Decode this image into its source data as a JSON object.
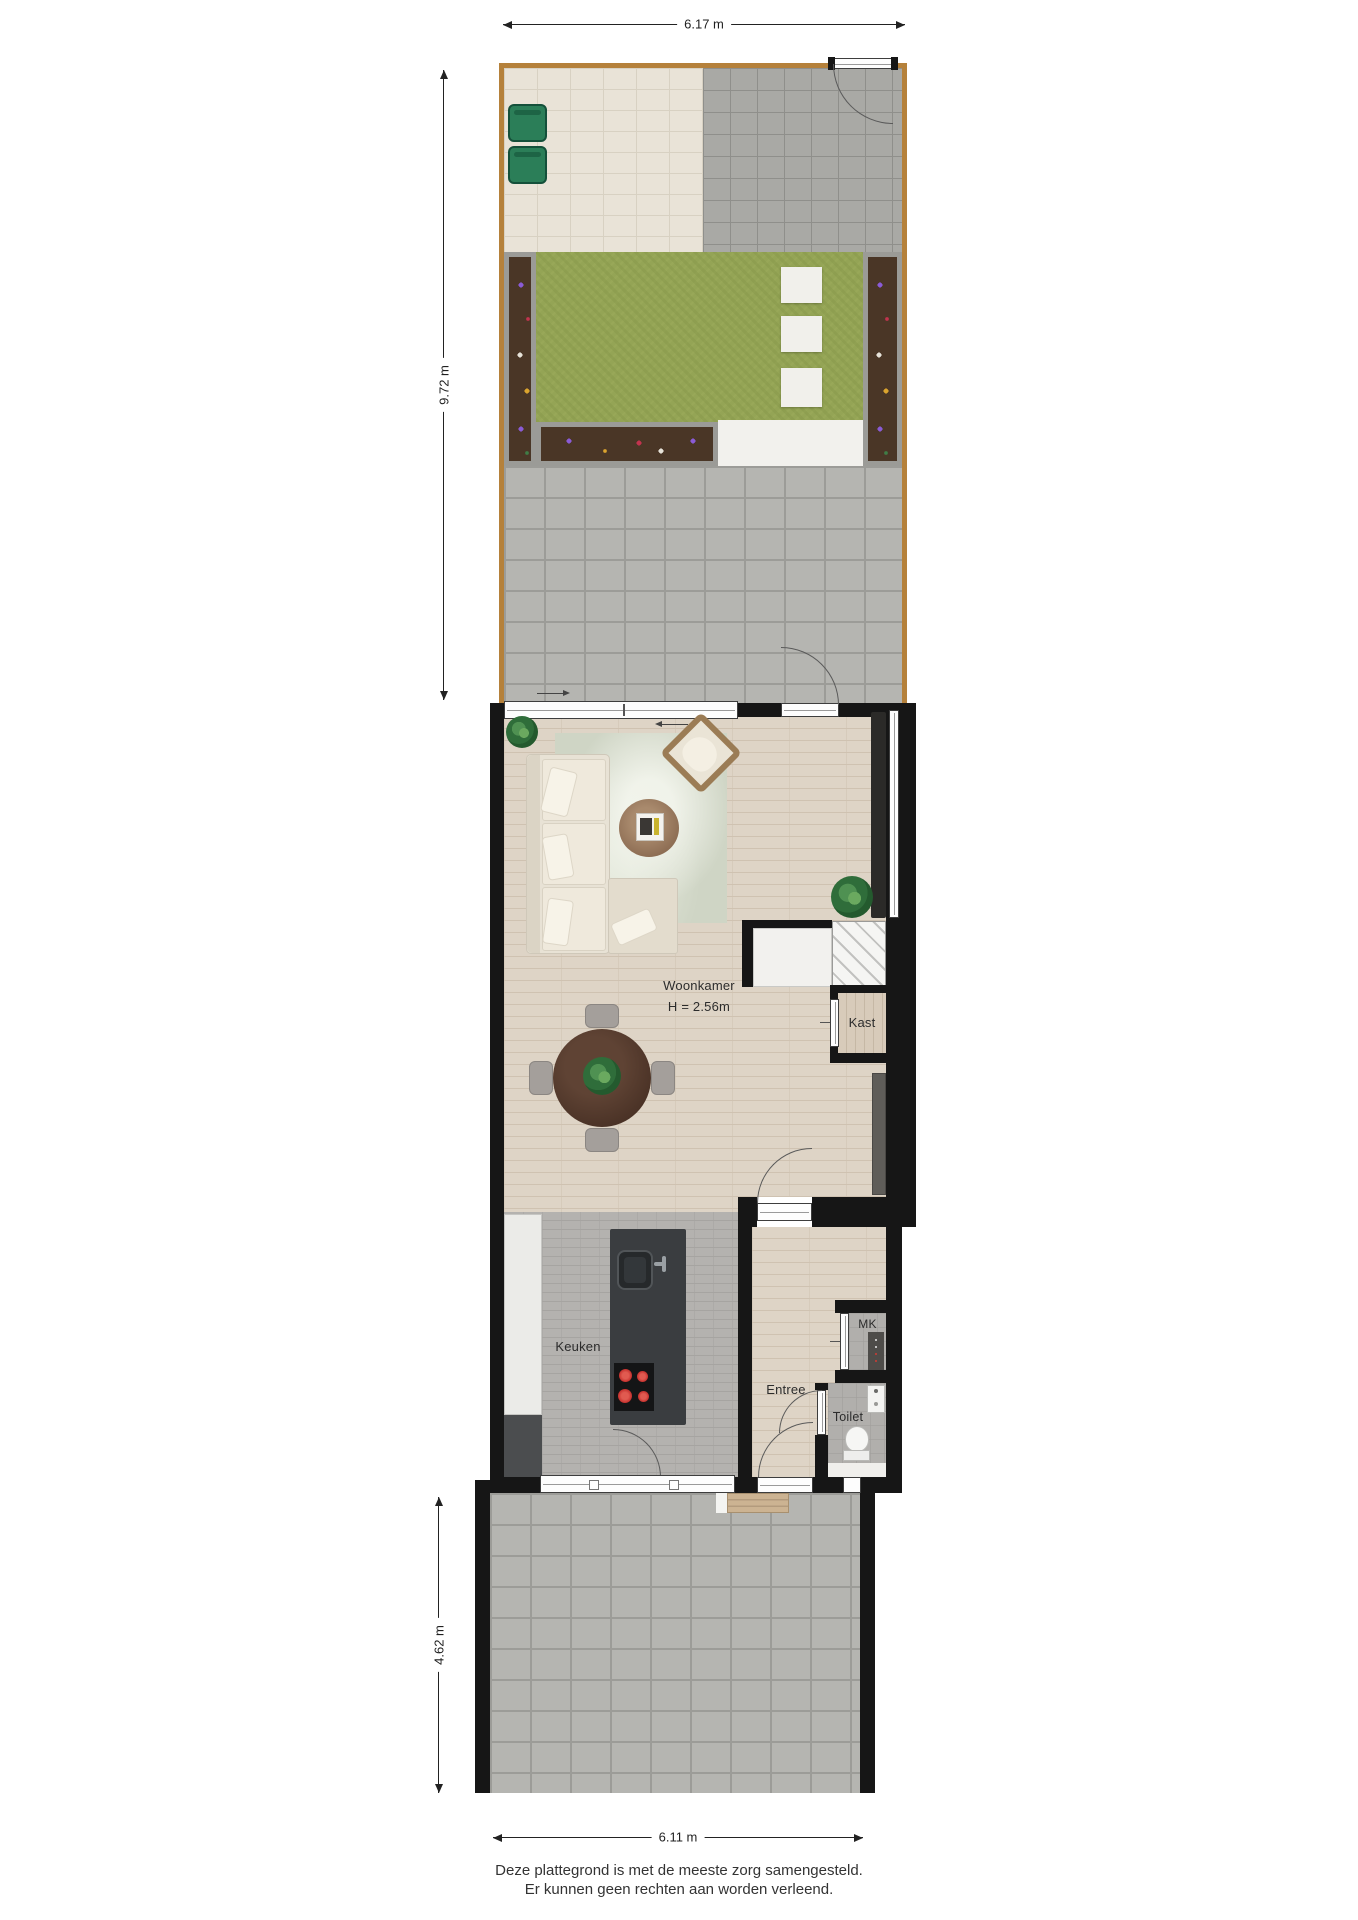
{
  "dimensions": {
    "garden_width": "6.17 m",
    "garden_depth": "9.72 m",
    "front_depth": "4.62 m",
    "front_width": "6.11 m"
  },
  "rooms": {
    "living": {
      "name": "Woonkamer",
      "ceiling": "H = 2.56m"
    },
    "closet": {
      "name": "Kast"
    },
    "kitchen": {
      "name": "Keuken"
    },
    "hall": {
      "name": "Entree"
    },
    "meter_closet": {
      "name": "MK"
    },
    "toilet": {
      "name": "Toilet"
    }
  },
  "footer": {
    "line1": "Deze plattegrond is met de meeste zorg samengesteld.",
    "line2": "Er kunnen geen rechten aan worden verleend."
  },
  "colors": {
    "wall": "#161616",
    "fence": "#b5813b",
    "lawn": "#94a455",
    "soil": "#4a3626",
    "island": "#3a3d40",
    "burner_red": "#cc3230",
    "rug": "#cfd5c5",
    "wood_floor": "#ded4c6"
  }
}
